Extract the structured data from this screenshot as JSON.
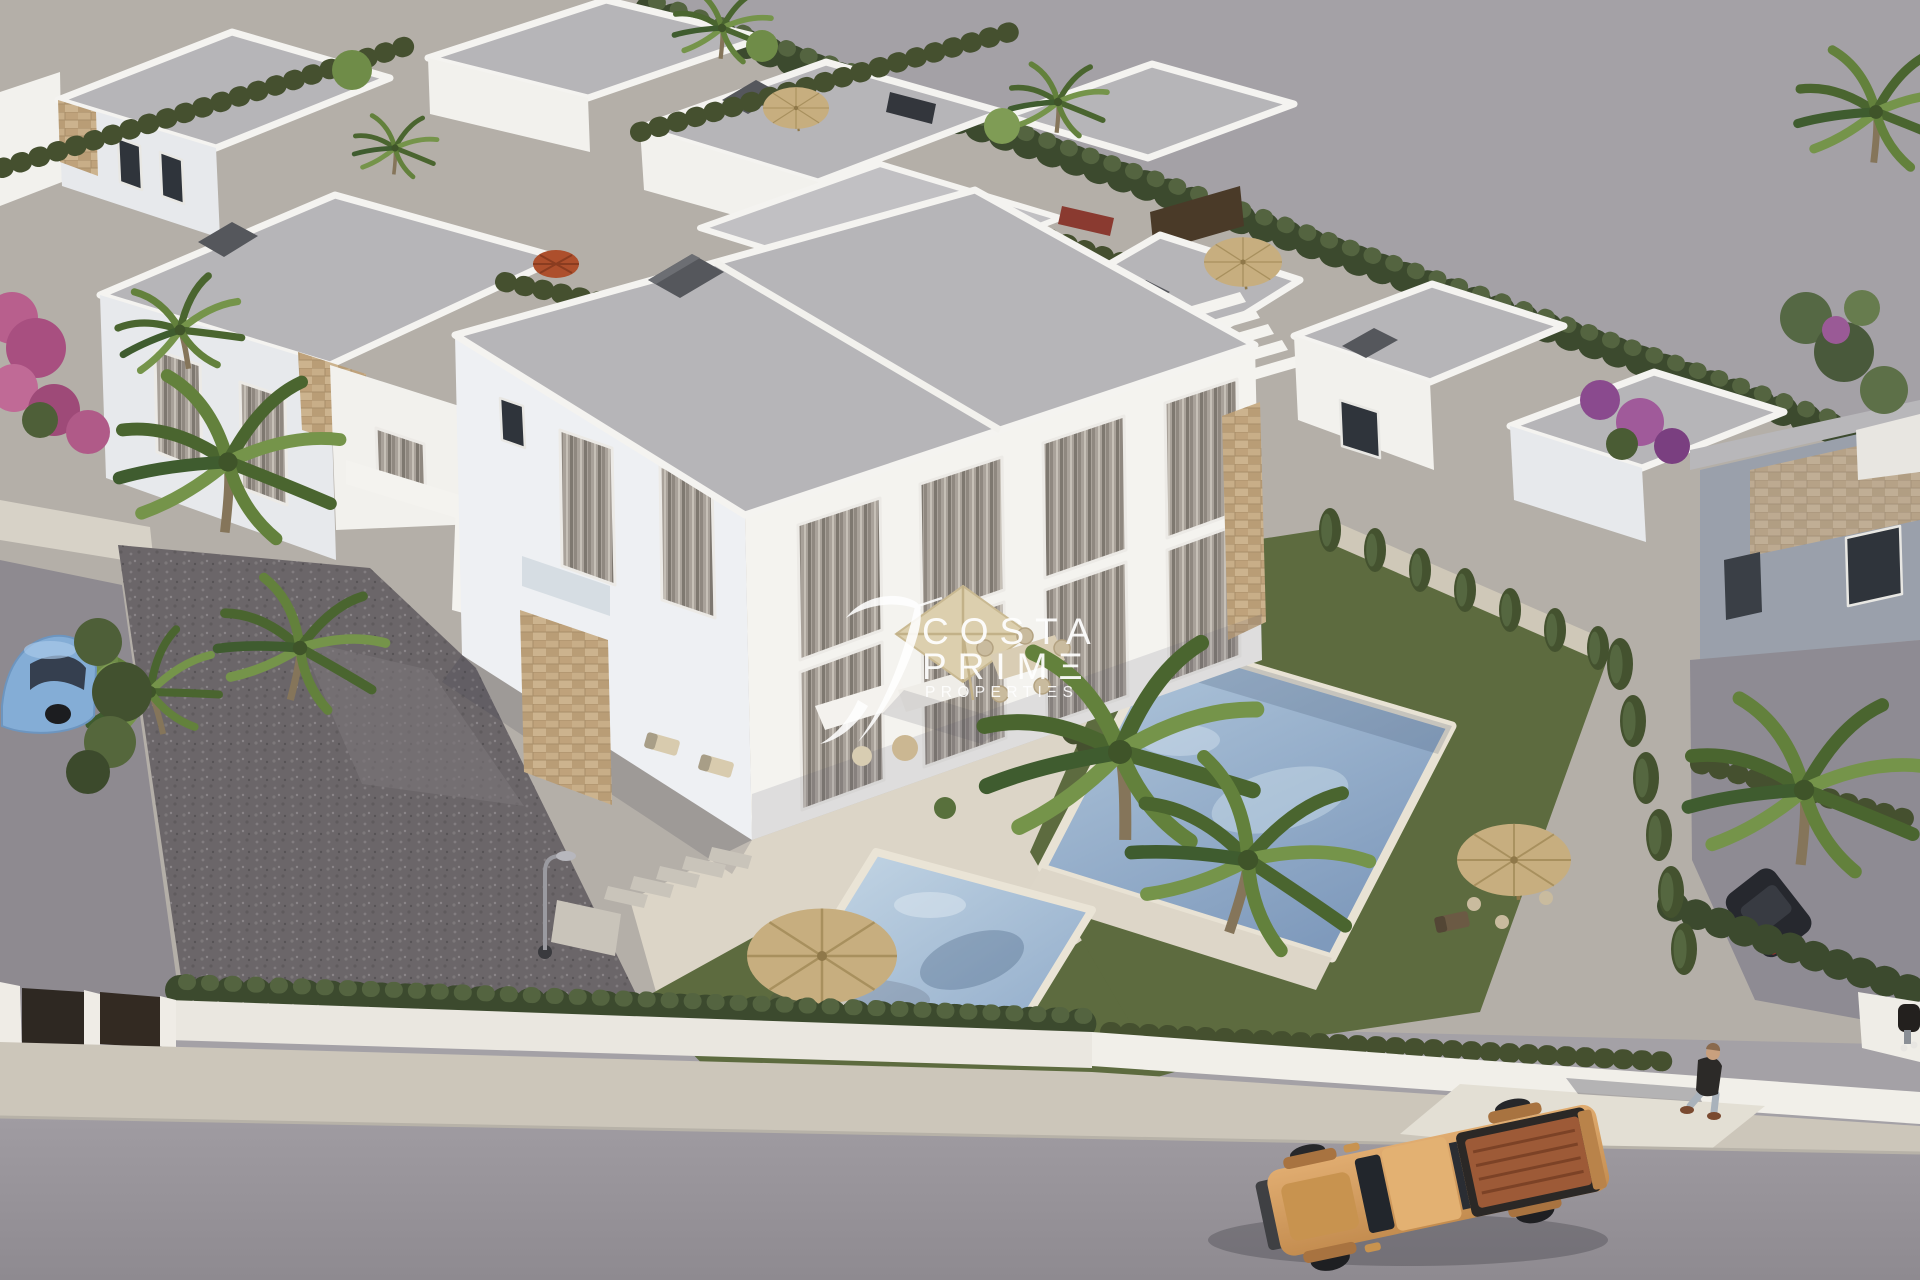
{
  "watermark": {
    "line1": "COSTA",
    "line2": "PRIMΞ",
    "line3": "PROPERTIΞS",
    "logo": "hummingbird-swoosh-logo",
    "color": "#ffffff"
  },
  "scene": {
    "kind": "aerial 3d architectural render",
    "subject": "modern white villa development with private pools, palm gardens and street",
    "palette": {
      "wall_white": "#f2f1ed",
      "wall_shade": "#e7e9ec",
      "roof_gray": "#b6b5b8",
      "stone_tan": "#c8ae88",
      "hedge_green": "#3c4a2e",
      "lawn_green": "#5d6b3f",
      "pool_blue": "#9db8d2",
      "deck_beige": "#dcd5c7",
      "gravel_gray": "#6b6669",
      "road_gray": "#99959b",
      "sidewalk_beige": "#ccc6ba",
      "field_gray": "#a4a1a6",
      "truck_orange": "#d69a5e",
      "truck_bed_copper": "#9d5a37",
      "car_blue": "#84add6",
      "parasol_straw": "#c7ae7f",
      "parasol_red": "#ad4f2c"
    },
    "objects": [
      "semi-detached two-storey villa",
      "neighbouring villas",
      "central swimming pool",
      "right swimming pool",
      "straw parasols",
      "beige terrace parasol",
      "palm trees",
      "cypress hedge rows",
      "perimeter white wall",
      "driveway gate",
      "street lamp",
      "stepping stones",
      "pickup truck",
      "blue car",
      "pedestrian",
      "pink bougainvillea"
    ]
  }
}
